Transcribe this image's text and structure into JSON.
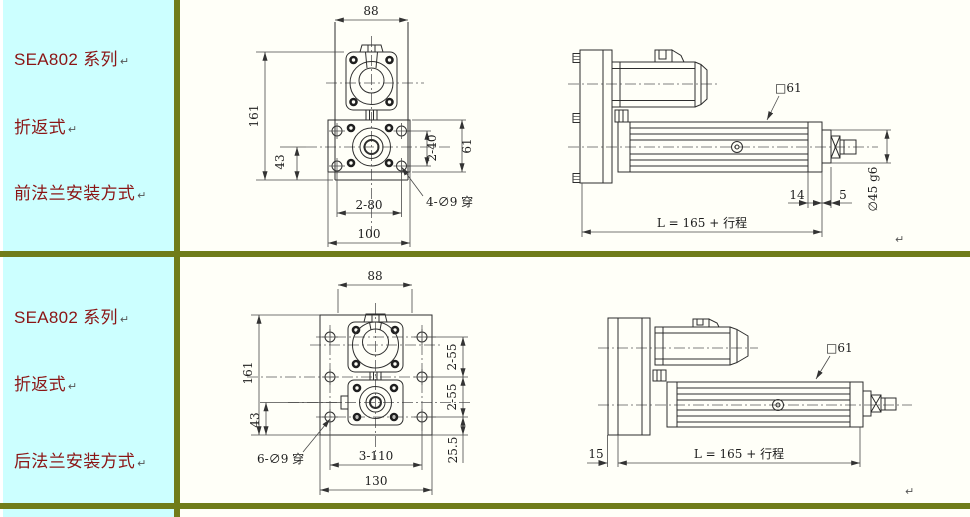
{
  "table": {
    "sidebar_bg": "#ccffff",
    "canvas_bg": "#fffff8",
    "border_color": "#707c1a",
    "sidebar_text_color": "#8b1515",
    "paragraph_mark": "↵"
  },
  "rows": [
    {
      "sidebar": {
        "series": "SEA802 系列",
        "style": "折返式",
        "mounting": "前法兰安装方式"
      },
      "front_view": {
        "width_top": "88",
        "height_left": "161",
        "offset_left": "43",
        "hole_pitch_bottom": "2-80",
        "overall_width": "100",
        "hole_pitch_right": "2-40",
        "plate_height_right": "61",
        "hole_note": "4-∅9 穿"
      },
      "side_view": {
        "square_size": "□61",
        "block_len": "14",
        "spacer_len": "5",
        "shaft_dia": "∅45 g6",
        "overall_length": "L = 165 + 行程"
      }
    },
    {
      "sidebar": {
        "series": "SEA802 系列",
        "style": "折返式",
        "mounting": "后法兰安装方式"
      },
      "front_view": {
        "width_top": "88",
        "height_left": "161",
        "offset_left": "43",
        "hole_note": "6-∅9 穿",
        "hole_pitch_bottom": "3-110",
        "overall_width": "130",
        "hole_pitch_right_1": "2-55",
        "hole_pitch_right_2": "2-55",
        "bottom_offset_right": "25.5"
      },
      "side_view": {
        "square_size": "□61",
        "plate_thickness": "15",
        "overall_length": "L = 165 + 行程"
      }
    }
  ]
}
